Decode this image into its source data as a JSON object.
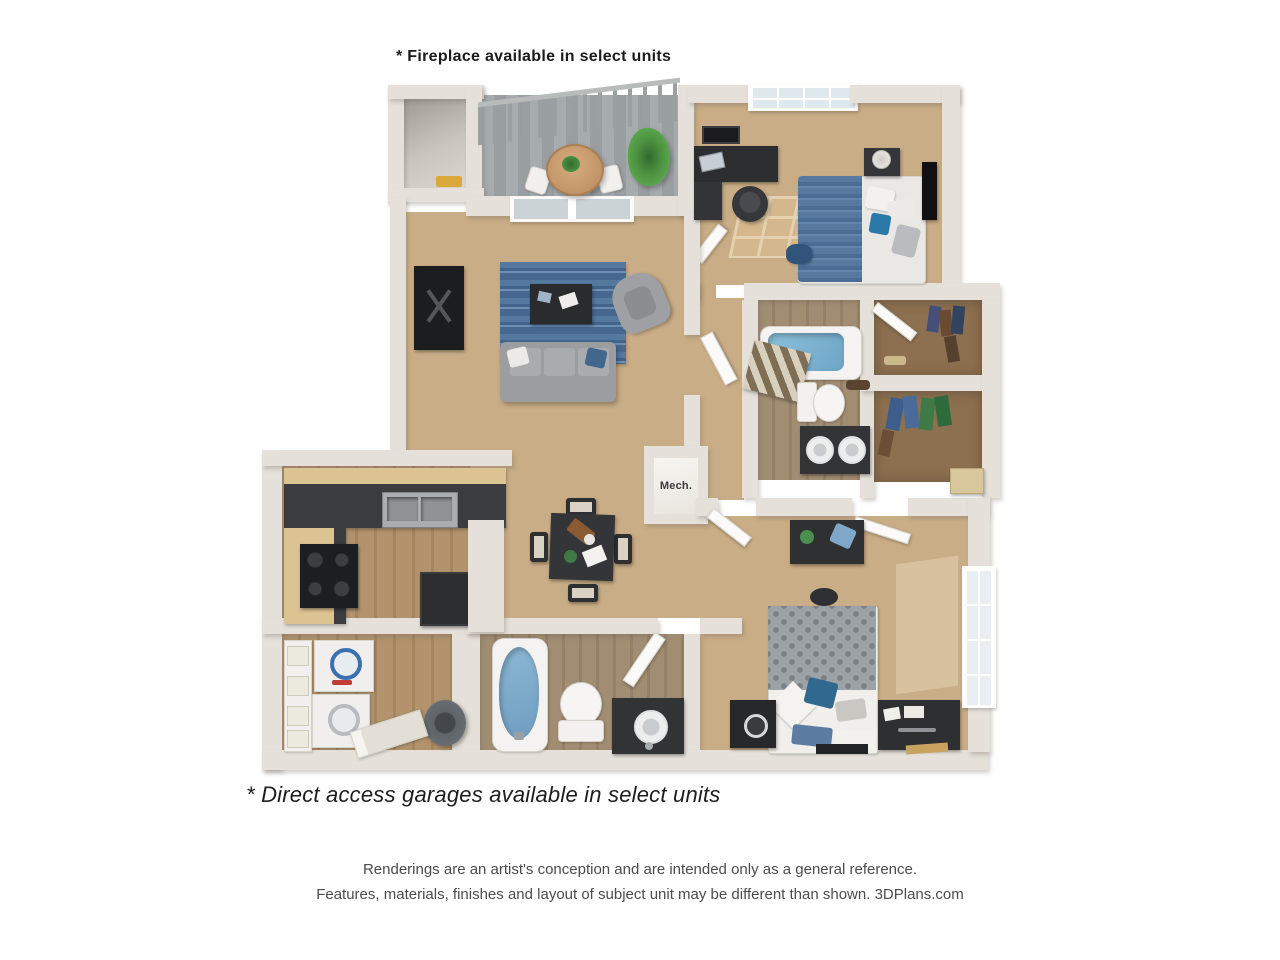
{
  "notes": {
    "fireplace": "* Fireplace available in select units",
    "garages": "* Direct access garages available in select units"
  },
  "disclaimer": {
    "line1": "Renderings are an artist's conception and are intended only as a general reference.",
    "line2": "Features, materials, finishes and layout of subject unit may be different than shown. 3DPlans.com"
  },
  "plan": {
    "mech_label": "Mech."
  },
  "colors": {
    "background": "#ffffff",
    "wall": "#e5e1da",
    "carpet": "#c9ad86",
    "wood_floor": "#ab8d66",
    "balcony_floor": "#9fa4a6",
    "closet_floor": "#8d7050",
    "rug_blue": "#46688e",
    "accent_blue": "#4f749c",
    "tub_blue": "#7db5d2",
    "dark_furniture": "#2c2d2f",
    "counter_dark": "#3b3c3e",
    "cabinet_wood": "#dcc394",
    "appliance_white": "#f0efed",
    "plant_green": "#4c8a44",
    "table_wood": "#c89a72",
    "duvet_gray": "#9da2a7",
    "sofa_gray": "#9b9da0"
  }
}
